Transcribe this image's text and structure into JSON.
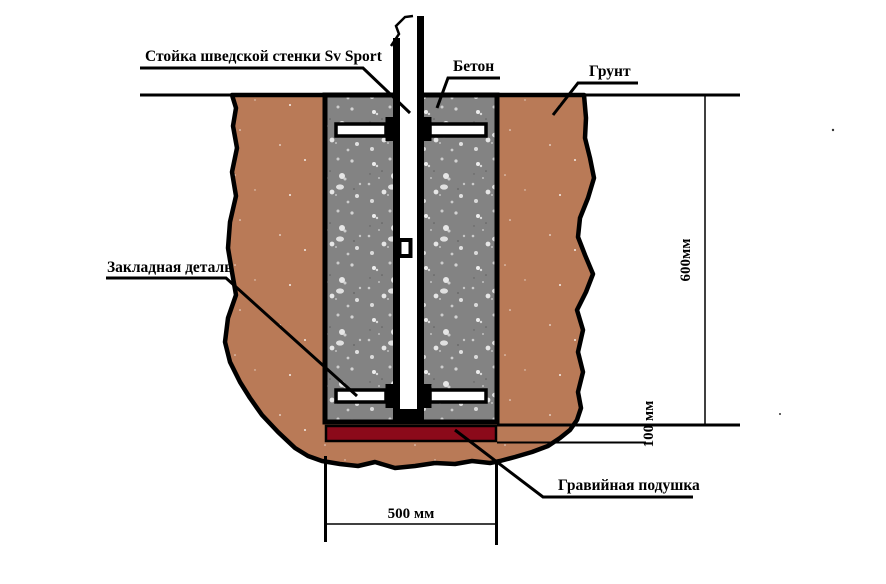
{
  "title": "Схема установки стойки шведской стенки",
  "labels": {
    "post": "Стойка шведской стенки Sv Sport",
    "concrete": "Бетон",
    "ground": "Грунт",
    "embed": "Закладная деталь",
    "gravel": "Гравийная подушка"
  },
  "dimensions": {
    "depth": "600мм",
    "gravel_thickness": "100 мм",
    "width": "500 мм"
  },
  "colors": {
    "soil": "#b97a57",
    "concrete": "#838383",
    "gravel": "#8b0a1a",
    "outline": "#000000",
    "background": "#ffffff"
  }
}
